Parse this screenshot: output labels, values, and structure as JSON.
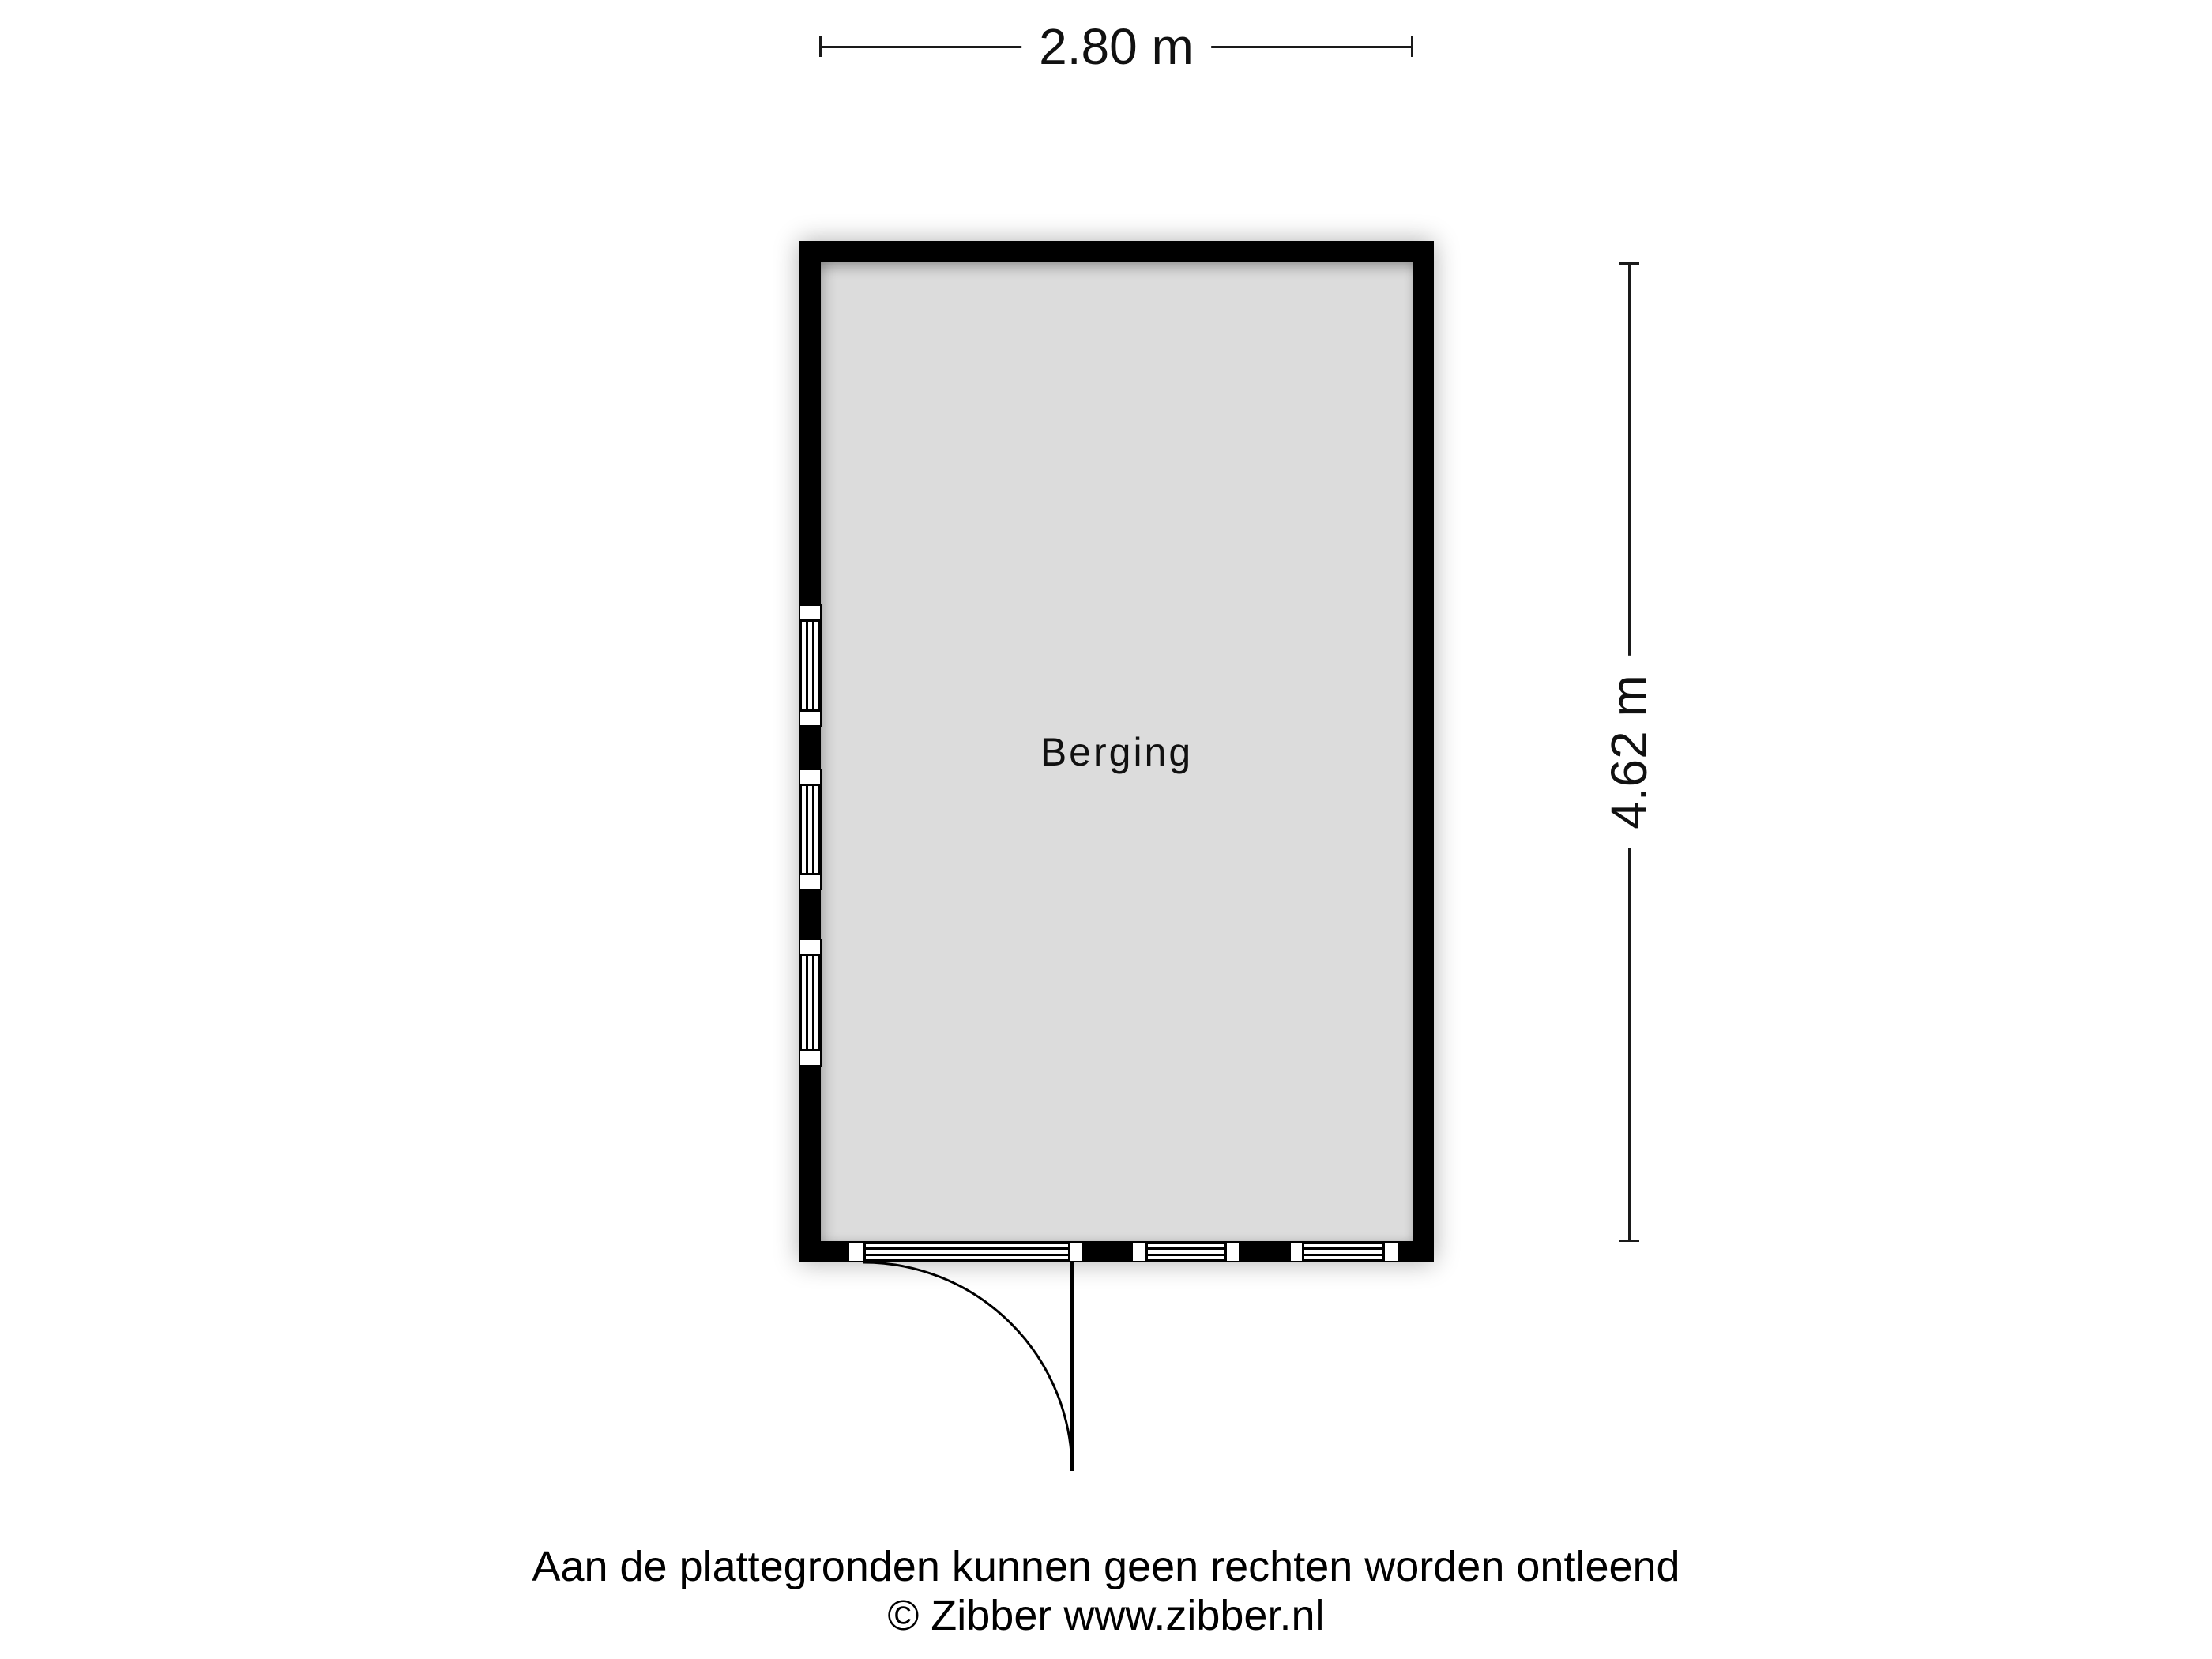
{
  "floorplan": {
    "room_label": "Berging",
    "width_label": "2.80 m",
    "height_label": "4.62 m"
  },
  "footer": {
    "disclaimer": "Aan de plattegronden kunnen geen rechten worden ontleend",
    "copyright": "© Zibber www.zibber.nl"
  },
  "colors": {
    "wall": "#000000",
    "floor": "#dcdcdc",
    "line": "#1a1a1a",
    "background": "#ffffff"
  }
}
